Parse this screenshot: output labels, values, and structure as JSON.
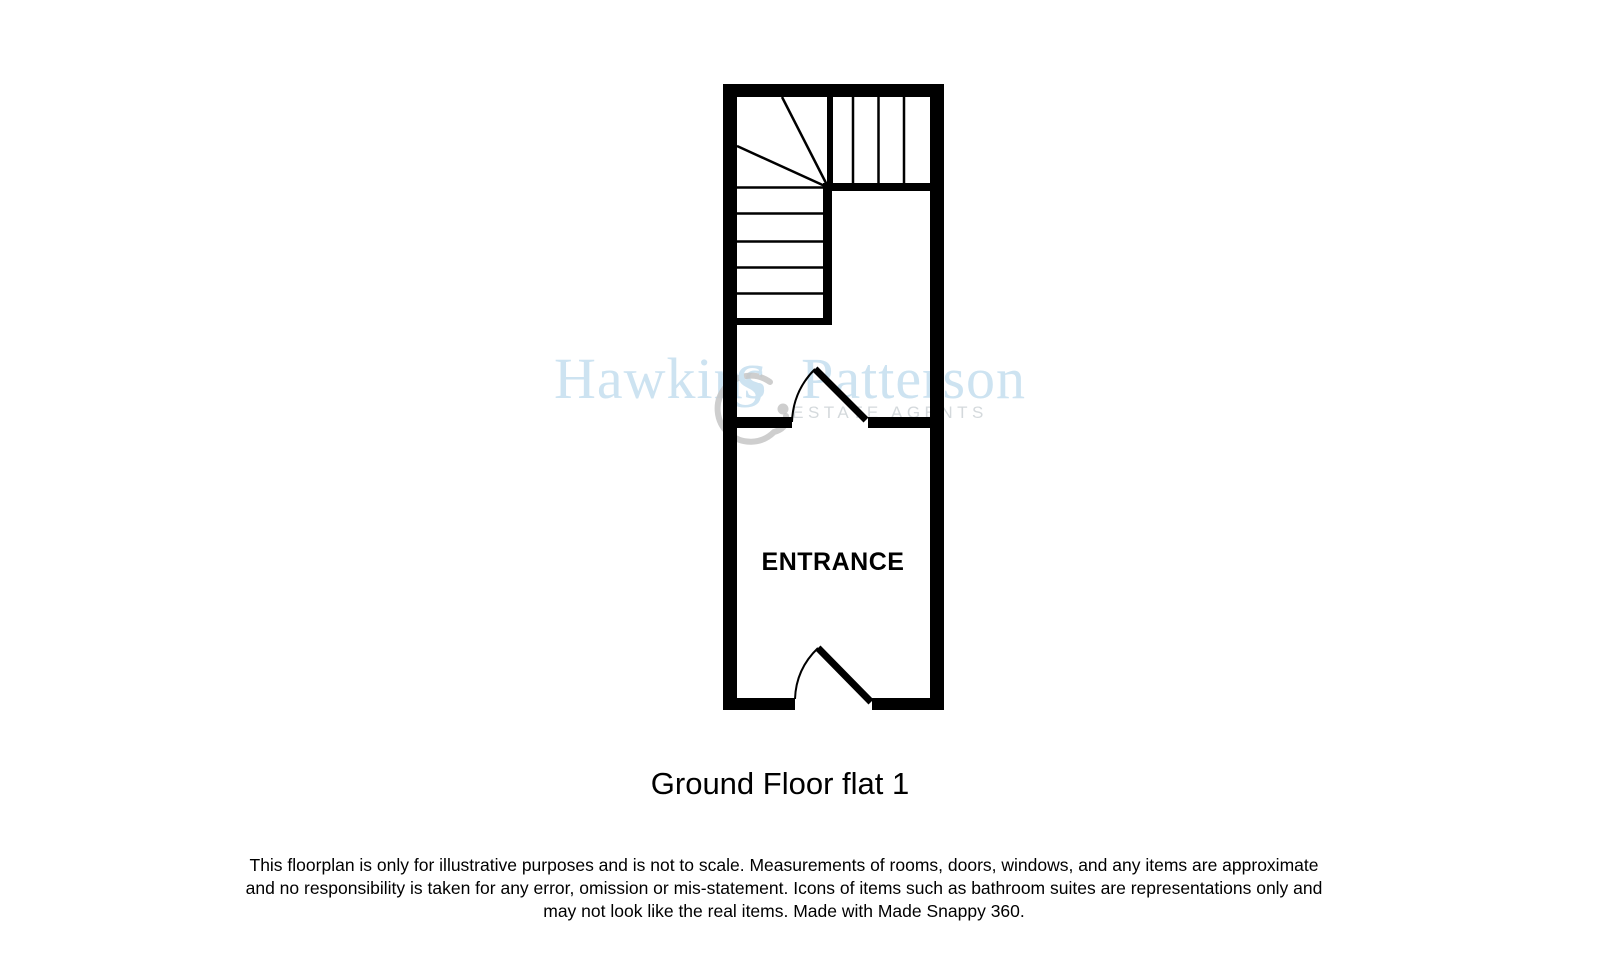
{
  "watermark": {
    "brand_first": "Hawkins",
    "brand_second": "Patterson",
    "tagline": "ESTATE AGENTS"
  },
  "floorplan": {
    "room_label": "ENTRANCE",
    "title": "Ground Floor flat 1"
  },
  "disclaimer": {
    "line1": "This floorplan is only for illustrative purposes and is not to scale. Measurements of rooms, doors, windows, and any items are approximate",
    "line2": "and no responsibility is taken for any error, omission or mis-statement. Icons of items such as bathroom suites are representations only and",
    "line3": "may not look like the real items. Made with Made Snappy 360."
  },
  "colors": {
    "wall": "#000000",
    "text": "#000000",
    "watermark_blue": "#cde3f1",
    "tagline_gray": "#d4d9dc",
    "swirl_gray": "#c6c6c6"
  }
}
